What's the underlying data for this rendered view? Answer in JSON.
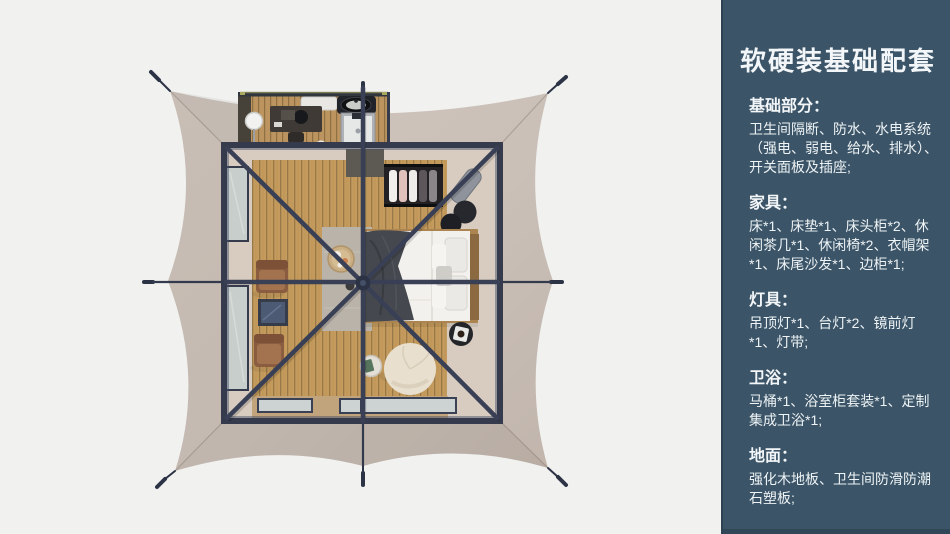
{
  "colors": {
    "page_bg": "#f1f1f0",
    "sidebar_bg": "#3b5467",
    "sidebar_edge": "#2d4355",
    "text_light": "#f3f6f8",
    "tent_canvas": "#cac0b8",
    "steel_frame": "#394056",
    "rope": "#2c3345",
    "wood_floor": "#c49b5c",
    "wood_gap": "#8f7242",
    "interior_wall": "#d8ccc0",
    "glass": "#c7cecb",
    "bed_linen": "#f3f1ed",
    "throw_blanket": "#45484e",
    "leather_chair": "#9c6b4c",
    "pouf": "#e8dfcf",
    "rug": "#b9b3a9",
    "black_furniture": "#232529"
  },
  "floorplan": {
    "description": "top-down 3D render of a square glamping tent: taupe stretched canvas with guy lines, dark steel frame with X roof beams, wood plank floor, bed with white linen, clothes rack, lounge chairs, pouf, and an attached bathroom annex at the top"
  },
  "sidebar": {
    "title": "软硬装基础配套",
    "sections": [
      {
        "heading": "基础部分：",
        "body": "卫生间隔断、防水、水电系统（强电、弱电、给水、排水）、开关面板及插座;"
      },
      {
        "heading": "家具：",
        "body": "床*1、床垫*1、床头柜*2、休闲茶几*1、休闲椅*2、衣帽架*1、床尾沙发*1、边柜*1;"
      },
      {
        "heading": "灯具：",
        "body": "吊顶灯*1、台灯*2、镜前灯*1、灯带;"
      },
      {
        "heading": "卫浴：",
        "body": "马桶*1、浴室柜套装*1、定制集成卫浴*1;"
      },
      {
        "heading": "地面：",
        "body": "强化木地板、卫生间防滑防潮石塑板;"
      }
    ]
  }
}
